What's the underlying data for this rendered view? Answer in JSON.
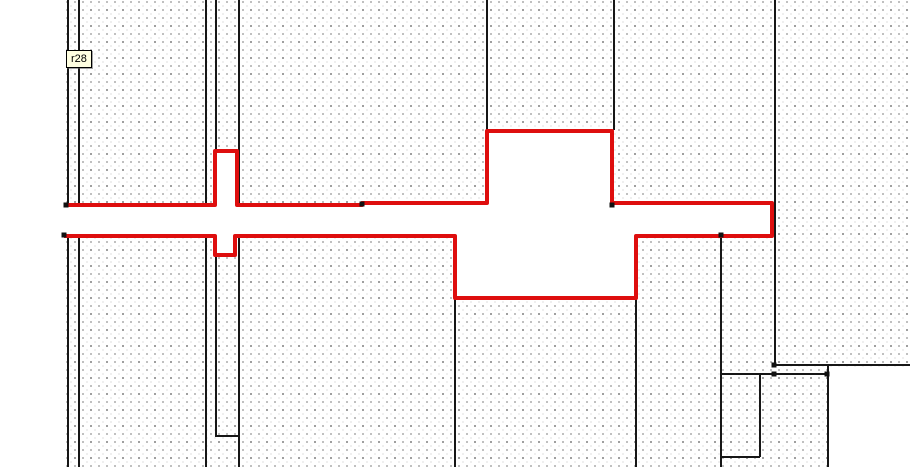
{
  "app": {
    "description": "CAD floor-plan editor canvas with dotted grid, black wall lines and a red highlighted room/corridor outline"
  },
  "tooltip": {
    "label": "r28",
    "x": 66,
    "y": 50,
    "bg_color": "#ffffe1"
  },
  "colors": {
    "canvas_white": "#ffffff",
    "grid_dot": "#9a9a9a",
    "wall_black": "#161616",
    "highlight_red": "#de0e0e",
    "handle_black": "#111111"
  },
  "drawing": {
    "canvas": {
      "width": 910,
      "height": 472
    },
    "grid": {
      "left": 66,
      "top": 0,
      "width": 844,
      "height": 467,
      "dot_spacing": 8
    },
    "white_regions": [
      {
        "x": 829,
        "y": 366.5,
        "w": 81,
        "h": 106
      }
    ],
    "walls": [
      {
        "x1": 68,
        "y1": 0,
        "x2": 68,
        "y2": 467
      },
      {
        "x1": 79,
        "y1": 0,
        "x2": 79,
        "y2": 467
      },
      {
        "x1": 206,
        "y1": 0,
        "x2": 206,
        "y2": 467
      },
      {
        "x1": 216,
        "y1": 0,
        "x2": 216,
        "y2": 437
      },
      {
        "x1": 239,
        "y1": 0,
        "x2": 239,
        "y2": 467
      },
      {
        "x1": 455,
        "y1": 298,
        "x2": 455,
        "y2": 467
      },
      {
        "x1": 487,
        "y1": 0,
        "x2": 487,
        "y2": 131
      },
      {
        "x1": 614,
        "y1": 0,
        "x2": 614,
        "y2": 130
      },
      {
        "x1": 636,
        "y1": 298,
        "x2": 636,
        "y2": 467
      },
      {
        "x1": 721,
        "y1": 233,
        "x2": 721,
        "y2": 467
      },
      {
        "x1": 775,
        "y1": 0,
        "x2": 775,
        "y2": 364
      },
      {
        "x1": 760,
        "y1": 374,
        "x2": 760,
        "y2": 457
      },
      {
        "x1": 828,
        "y1": 366,
        "x2": 828,
        "y2": 467
      },
      {
        "x1": 774,
        "y1": 365,
        "x2": 910,
        "y2": 365
      },
      {
        "x1": 721,
        "y1": 374,
        "x2": 828,
        "y2": 374
      },
      {
        "x1": 721,
        "y1": 457,
        "x2": 760,
        "y2": 457
      },
      {
        "x1": 216,
        "y1": 436,
        "x2": 239,
        "y2": 436
      }
    ],
    "highlight_outline": {
      "stroke_width": 4,
      "points": [
        [
          64,
          205
        ],
        [
          215,
          205
        ],
        [
          215,
          151
        ],
        [
          237,
          151
        ],
        [
          237,
          205
        ],
        [
          362,
          205
        ],
        [
          362,
          203
        ],
        [
          487,
          203
        ],
        [
          487,
          131
        ],
        [
          612,
          131
        ],
        [
          612,
          203
        ],
        [
          772,
          203
        ],
        [
          772,
          236
        ],
        [
          636,
          236
        ],
        [
          636,
          298
        ],
        [
          455,
          298
        ],
        [
          455,
          236
        ],
        [
          235,
          236
        ],
        [
          235,
          255
        ],
        [
          215,
          255
        ],
        [
          215,
          236
        ],
        [
          64,
          236
        ]
      ]
    },
    "handles": [
      [
        66,
        205
      ],
      [
        64,
        235
      ],
      [
        362,
        204
      ],
      [
        612,
        205
      ],
      [
        721,
        235
      ],
      [
        774,
        365
      ],
      [
        774,
        374
      ],
      [
        827,
        374
      ]
    ]
  }
}
